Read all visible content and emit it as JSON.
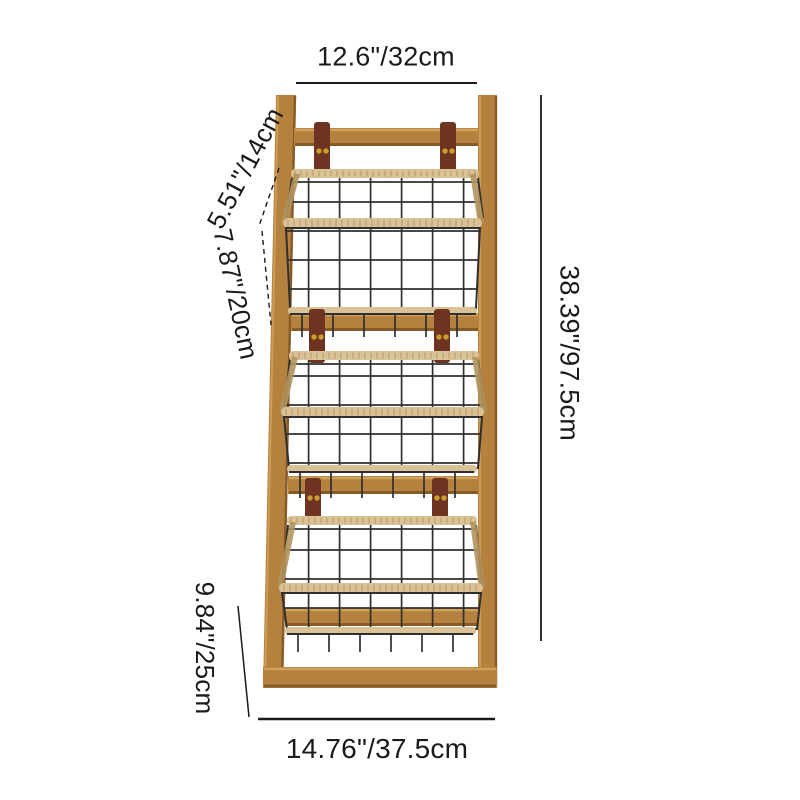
{
  "product_diagram": {
    "description": "three-tier wooden ladder rack with hanging wire baskets",
    "dimensions": {
      "top_width": "12.6\"/32cm",
      "overall_height": "38.39\"/97.5cm",
      "basket_depth": "5.51\"/14cm",
      "basket_height": "7.87\"/20cm",
      "lower_section_height": "9.84\"/25cm",
      "bottom_width": "14.76\"/37.5cm"
    },
    "colors": {
      "wood": "#b5813f",
      "wood_light": "#d5a861",
      "wood_dark": "#7d5220",
      "strap": "#6e3421",
      "rivet": "#c69d2e",
      "wire": "#2f2f2f",
      "jute": "#d9c296",
      "jute_dark": "#b2945f",
      "dimension_line": "#1a1a1a",
      "background": "#ffffff"
    }
  }
}
